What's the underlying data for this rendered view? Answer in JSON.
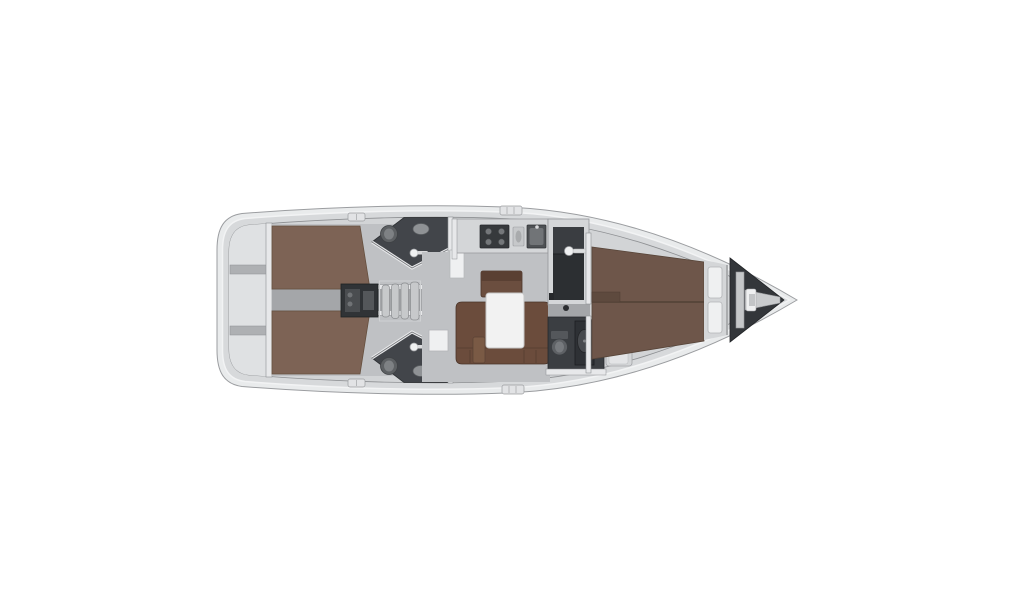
{
  "diagram": {
    "kind": "yacht-interior-floorplan",
    "orientation": "bow-right",
    "regions": [
      "stern-lazarette",
      "aft-cabin-port",
      "aft-cabin-starboard",
      "aft-head-port",
      "aft-head-starboard",
      "engine-compartment",
      "companionway-steps",
      "galley",
      "salon-settee",
      "salon-table",
      "wardrobe",
      "forward-head",
      "forward-cabin-berth",
      "bow-lockers",
      "anchor-locker"
    ]
  },
  "colors": {
    "background": "#ffffff",
    "hull_line": "#9b9da0",
    "deck_light": "#e9ebec",
    "deck": "#d7d9db",
    "interior": "#d2d4d6",
    "stern": "#dfe1e3",
    "floor": "#bfc1c4",
    "corridor": "#a4a6a9",
    "wall": "#e7e8ea",
    "wall_edge": "#8e9093",
    "berth_aft": "#7d6355",
    "berth_fore": "#6e564a",
    "settee": "#6b4c3c",
    "bench": "#6b4e3f",
    "stool": "#7a5a45",
    "table": "#f2f2f2",
    "counter": "#d4d6d8",
    "stove": "#36393c",
    "sink": "#4e5154",
    "dark_room": "#42454a",
    "head_fore": "#3b3e42",
    "cabinet": "#2c2f32",
    "engine": "#303336",
    "anchor_locker": "#33363a",
    "steps": "#c7c9cb",
    "white_detail": "#eff0f1",
    "fixture": "#5d6063"
  }
}
